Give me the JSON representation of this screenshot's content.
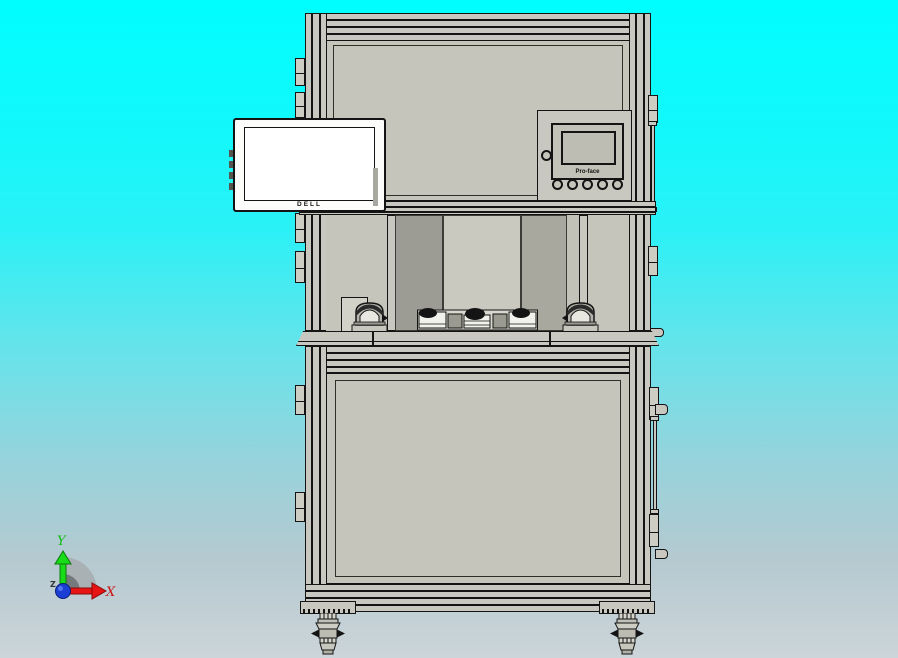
{
  "viewport": {
    "background_top": "#00feff",
    "background_bottom": "#ccd5d9"
  },
  "machine": {
    "monitor": {
      "brand_label": "DELL",
      "screen_color": "#ffffff"
    },
    "hmi": {
      "brand_label": "Pro-face",
      "round_button_count": "5"
    },
    "colors": {
      "frame": "#c8c8c0",
      "panel": "#c5c5bb",
      "outline": "#141414",
      "opening_dark": "#9c9c94",
      "opening_light": "#c9c9bf",
      "opening_medium": "#a8a89e"
    }
  },
  "triad": {
    "x_label": "X",
    "y_label": "Y",
    "z_label": "Z",
    "x_color": "#e81414",
    "y_color": "#19dc19",
    "origin_color": "#1b3fd4"
  }
}
